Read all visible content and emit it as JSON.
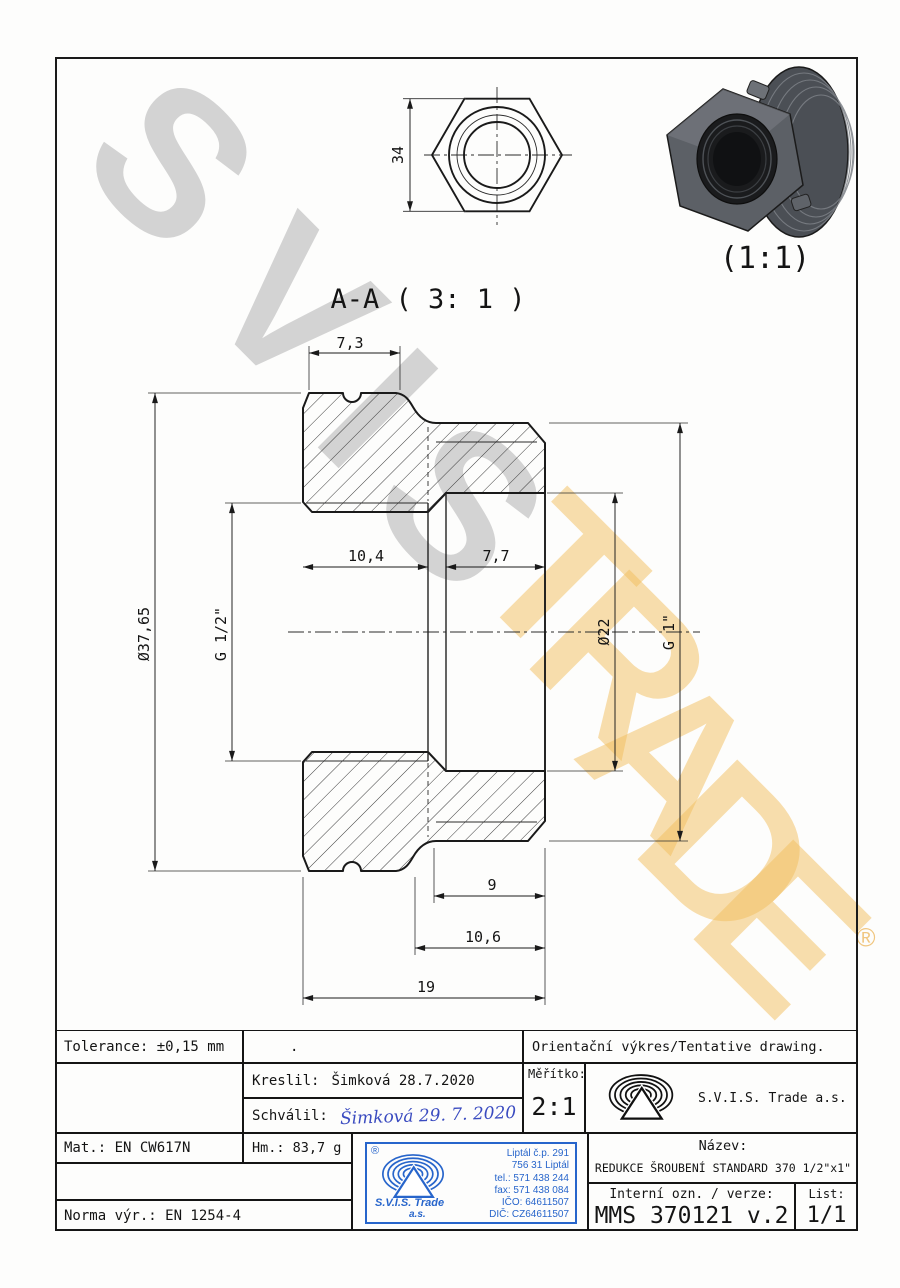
{
  "page": {
    "bg": "#fdfdfc",
    "frame_color": "#1a1a1a"
  },
  "watermark": {
    "gray": [
      "S",
      "V",
      "I",
      "S"
    ],
    "orange": [
      "T",
      "R",
      "A",
      "D",
      "E"
    ],
    "registered": "®",
    "gray_color": "#c9c9c9",
    "orange_color": "#f3bf5e"
  },
  "views": {
    "section": {
      "label": "A-A ( 3: 1 )",
      "dims": {
        "w_flange": "7,3",
        "l_left_bore": "10,4",
        "l_right_bore": "7,7",
        "d_outer": "Ø37,65",
        "t_left": "G 1/2\"",
        "d_tube": "Ø22",
        "t_right": "G 1\"",
        "l_thread": "9",
        "l_body": "10,6",
        "l_total": "19"
      }
    },
    "top": {
      "across_flats": "34"
    },
    "iso": {
      "scale": "(1:1)"
    }
  },
  "title_block": {
    "tolerance": "Tolerance: ±0,15 mm",
    "empty_dot": ".",
    "orientation_note": "Orientační výkres/Tentative drawing.",
    "kreslil_label": "Kreslil:",
    "kreslil_value": "Šimková 28.7.2020",
    "schvalil_label": "Schválil:",
    "schvalil_signature": "Šimková 29. 7. 2020",
    "meritko_label": "Měřítko:",
    "meritko_value": "2:1",
    "company": "S.V.I.S. Trade a.s.",
    "mat": "Mat.: EN CW617N",
    "hm": "Hm.: 83,7 g",
    "norma": "Norma výr.: EN 1254-4",
    "nazev_label": "Název:",
    "nazev_value": "REDUKCE ŠROUBENÍ STANDARD 370 1/2\"x1\"",
    "interni_label": "Interní ozn. / verze:",
    "interni_value": "MMS 370121 v.2",
    "list_label": "List:",
    "list_value": "1/1",
    "stamp": {
      "registered": "®",
      "company_line1": "S.V.I.S. Trade",
      "company_line2": "a.s.",
      "address": [
        "Liptál č.p. 291",
        "756 31 Liptál",
        "tel.: 571 438 244",
        "fax: 571 438 084",
        "IČO: 64611507",
        "DIČ: CZ64611507"
      ],
      "color": "#2765cb"
    },
    "signature_color": "#3a4bc0"
  }
}
